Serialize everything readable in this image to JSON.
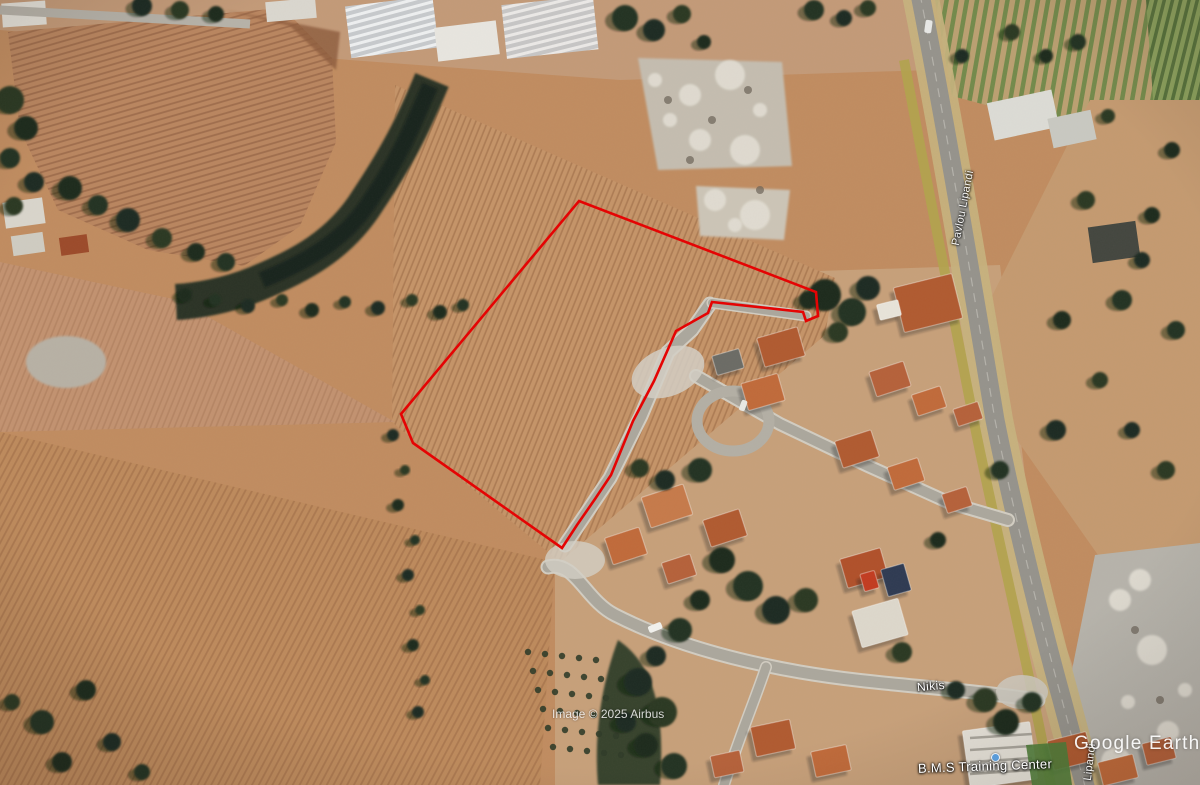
{
  "app": {
    "name": "Google Earth"
  },
  "watermark": {
    "logo_text": "Google Earth"
  },
  "attribution": {
    "imagery_credit": "Image © 2025 Airbus"
  },
  "labels": {
    "street_nikis": "Nikis",
    "street_main_road": "Pavlou Lipandi",
    "street_main_road_partial": "Lipandi",
    "poi_training_center": "B.M.S Training Center"
  },
  "overlay": {
    "parcel_boundary_color": "#e60000",
    "parcel_boundary_points_px": [
      [
        579,
        201
      ],
      [
        816,
        292
      ],
      [
        818,
        316
      ],
      [
        806,
        321
      ],
      [
        803,
        312
      ],
      [
        712,
        302
      ],
      [
        708,
        313
      ],
      [
        676,
        331
      ],
      [
        654,
        381
      ],
      [
        633,
        421
      ],
      [
        611,
        475
      ],
      [
        595,
        499
      ],
      [
        577,
        525
      ],
      [
        562,
        548
      ],
      [
        413,
        443
      ],
      [
        401,
        414
      ]
    ]
  }
}
